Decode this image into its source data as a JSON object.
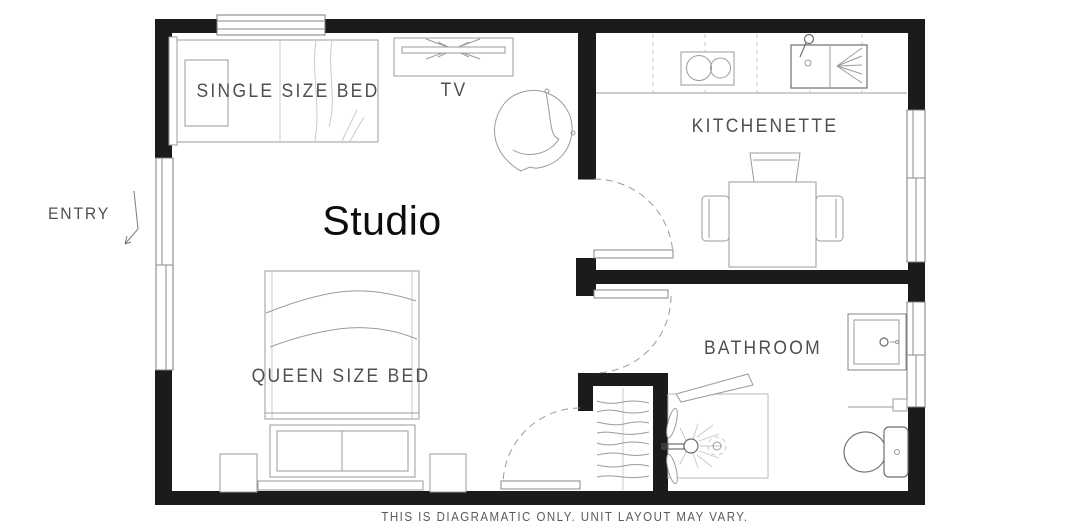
{
  "labels": {
    "entry": "ENTRY",
    "single_bed": "SINGLE SIZE BED",
    "tv": "TV",
    "studio": "Studio",
    "queen_bed": "QUEEN SIZE BED",
    "kitchenette": "KITCHENETTE",
    "bathroom": "BATHROOM",
    "disclaimer": "THIS IS DIAGRAMATIC ONLY. UNIT LAYOUT MAY VARY."
  },
  "colors": {
    "wall": "#1b1b1b",
    "line": "#9b9b9b",
    "line_dark": "#6e6e6e",
    "line_light": "#c6c6c6",
    "text": "#4f4f4f",
    "title_text": "#0d0d0d",
    "background": "#ffffff"
  },
  "symbols": [
    "single-bed",
    "pillow",
    "tv-unit",
    "armchair",
    "queen-bed",
    "blanket-bench",
    "nightstand",
    "kitchen-counter",
    "cooktop",
    "kitchen-sink",
    "dining-table",
    "chair",
    "wardrobe",
    "shower",
    "shower-head",
    "toilet",
    "vanity-sink",
    "window",
    "door-swing",
    "entry-arrow"
  ]
}
